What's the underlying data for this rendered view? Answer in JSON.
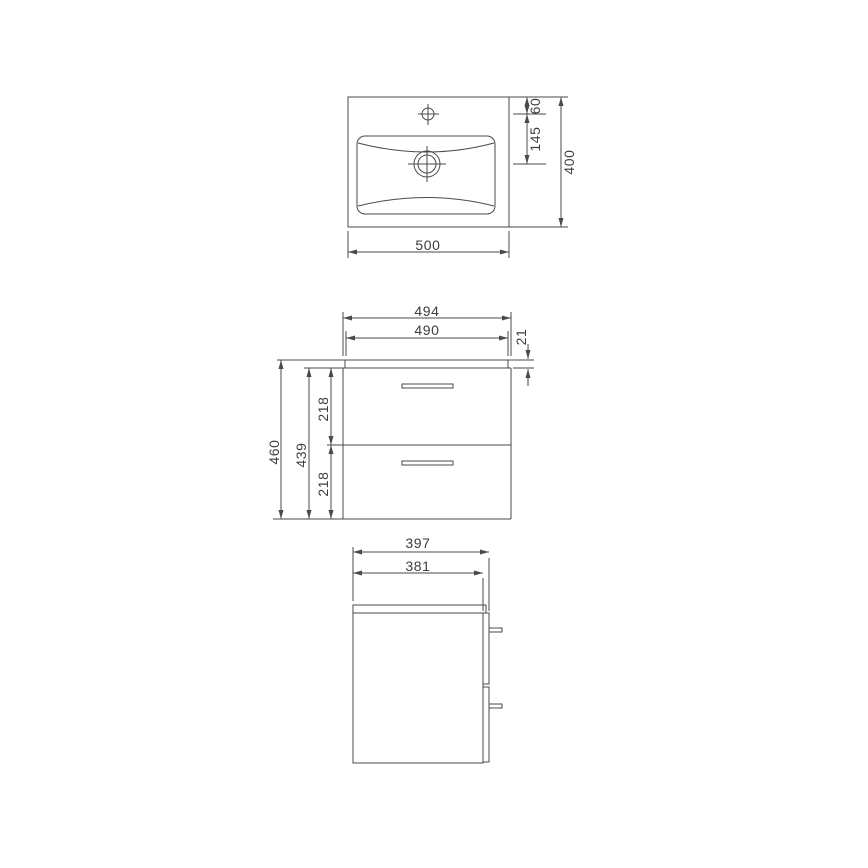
{
  "title": "Washbasin vanity unit technical drawing",
  "colors": {
    "background": "#ffffff",
    "line": "#4a4a4a",
    "text": "#3d3d3d"
  },
  "views": {
    "top": {
      "name": "washbasin top view",
      "width_mm": "500",
      "depth_mm": "400",
      "tap_hole_offset_mm": "60",
      "tap_to_drain_mm": "145"
    },
    "front": {
      "name": "cabinet front view",
      "overall_width_mm": "494",
      "carcass_width_mm": "490",
      "worktop_thickness_mm": "21",
      "overall_height_mm": "460",
      "carcass_height_mm": "439",
      "upper_drawer_height_mm": "218",
      "lower_drawer_height_mm": "218"
    },
    "side": {
      "name": "cabinet side view",
      "overall_depth_mm": "397",
      "carcass_depth_mm": "381"
    }
  }
}
